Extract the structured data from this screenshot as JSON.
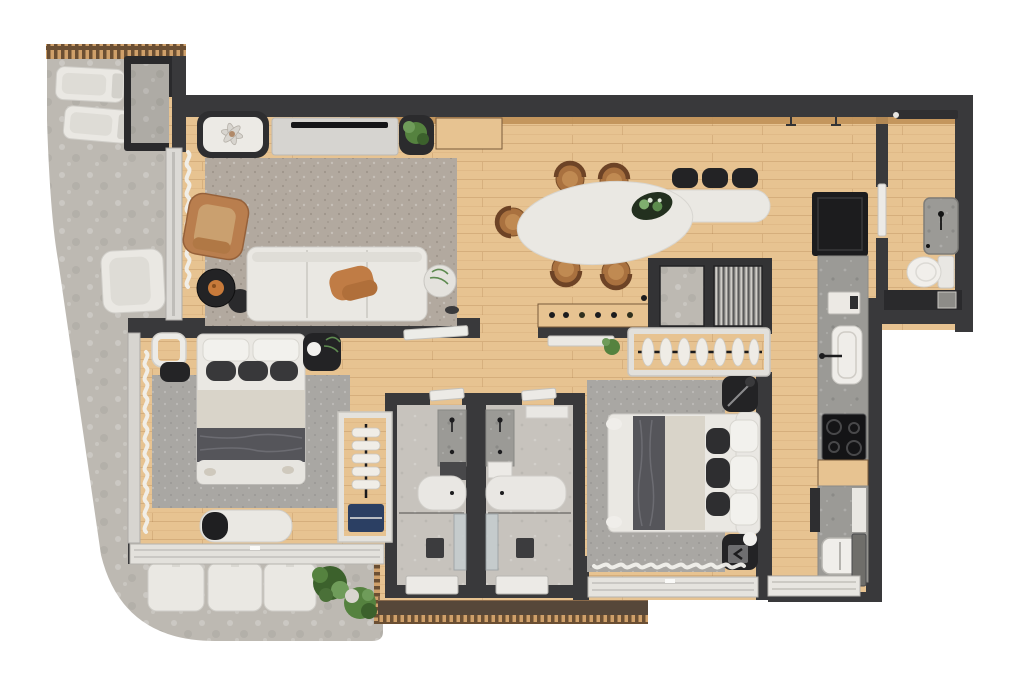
{
  "meta": {
    "kind": "apartment-floor-plan-render",
    "view": "top-down",
    "text_visible": false
  },
  "colors": {
    "wall": "#39393b",
    "walldark": "#2a2a2c",
    "wood": "#e7c391",
    "woodtrim": "#c09158",
    "woodtrimdark": "#7a5b3a",
    "terrace": "#bdb9b2",
    "rug": "#b2a99f",
    "rug2": "#a9a7a3",
    "whitefurn": "#eae8e3",
    "whitestroke": "#cfcdc8",
    "blackfurn": "#232325",
    "counter": "#9b9a96",
    "bathfloor": "#c7c3bd",
    "glass": "#c5cdcf",
    "tan": "#b97e4e",
    "chairwood": "#a9713f",
    "green": "#55823f",
    "greendark": "#3c612c",
    "navy": "#2b3f63",
    "orange": "#c87a3a",
    "deck": "#564739",
    "blanket": "#55555a",
    "beige": "#d9d4c9",
    "background": "#ffffff"
  },
  "rooms": [
    {
      "name": "terrace",
      "furniture": [
        "lounge-chair",
        "lounge-chair",
        "planter-box",
        "armchair",
        "seat-cushion",
        "seat-cushion",
        "seat-cushion",
        "potted-plant",
        "potted-plant"
      ]
    },
    {
      "name": "living-room",
      "furniture": [
        "area-rug",
        "modular-sofa",
        "throw-blanket",
        "leather-armchair",
        "round-coffee-table",
        "round-side-table",
        "plant-side-table",
        "tv-console",
        "tv",
        "decor-niche-flower",
        "planter",
        "wood-shelf",
        "curtains"
      ]
    },
    {
      "name": "dining-area",
      "furniture": [
        "oval-table",
        "bar-counter-extension",
        "dining-chair",
        "dining-chair",
        "dining-chair",
        "dining-chair",
        "dining-chair",
        "bar-stool",
        "bar-stool",
        "bar-stool",
        "centerpiece-plant",
        "sideboard-with-bottles",
        "pendant-lights"
      ]
    },
    {
      "name": "kitchen",
      "furniture": [
        "refrigerator",
        "countertop",
        "small-appliance",
        "sink-with-faucet",
        "cooktop",
        "wood-cabinet"
      ]
    },
    {
      "name": "service-area",
      "furniture": [
        "counter",
        "laundry-tank",
        "tall-cabinet",
        "window"
      ]
    },
    {
      "name": "powder-room",
      "furniture": [
        "washbasin-cabinet",
        "toilet",
        "counter",
        "door"
      ]
    },
    {
      "name": "bathroom-left",
      "furniture": [
        "vanity-counter",
        "basin",
        "toilet-box",
        "shower-glass",
        "shower-drain",
        "frosted-window",
        "door"
      ]
    },
    {
      "name": "bathroom-right",
      "furniture": [
        "vanity-counter",
        "basin",
        "shelf",
        "shower-glass",
        "shower-drain",
        "frosted-window",
        "door"
      ]
    },
    {
      "name": "bedroom-1",
      "furniture": [
        "double-bed",
        "pillows",
        "nightstand",
        "nightstand-with-lamp",
        "area-rug",
        "bench",
        "open-wardrobe",
        "curtains",
        "window"
      ]
    },
    {
      "name": "bedroom-2",
      "furniture": [
        "double-bed",
        "pillows",
        "nightstand",
        "nightstand-with-lamp",
        "area-rug",
        "open-clothes-rack",
        "sliding-door",
        "plant",
        "curtains",
        "window"
      ]
    },
    {
      "name": "technical-shaft",
      "furniture": [
        "concrete-panel",
        "ribbed-unit"
      ]
    },
    {
      "name": "entry",
      "furniture": [
        "entry-door"
      ]
    }
  ]
}
